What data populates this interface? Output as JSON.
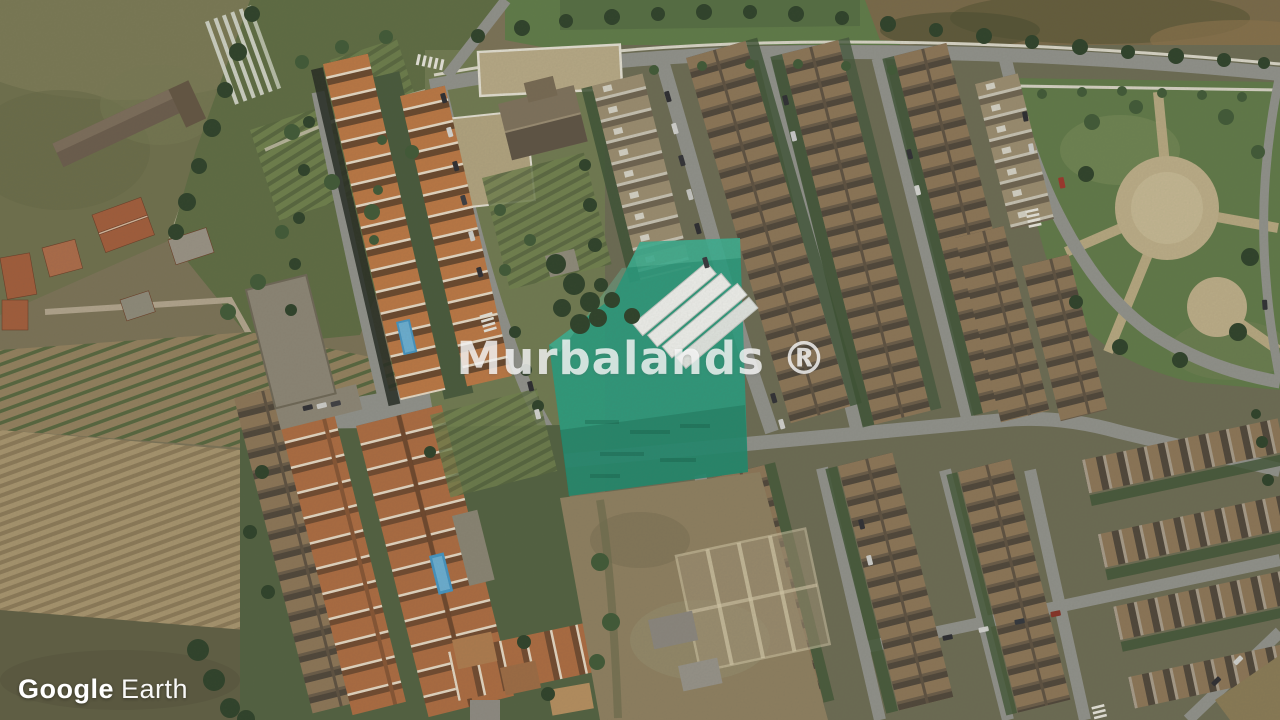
{
  "map": {
    "view_type": "satellite aerial imagery",
    "center_watermark": {
      "text": "Murbalands ®"
    },
    "attribution": {
      "brand": "Google",
      "product": "Earth"
    },
    "highlighted_plot": {
      "label": "highlighted land plot overlay",
      "color": "#1ea07f",
      "opacity": 0.88
    },
    "palette": {
      "road": "#90918a",
      "sidewalk": "#dcd8c8",
      "park-grass": "#5e7943",
      "field-olive": "#6e7048",
      "scrub": "#7a6844",
      "dirt-lot": "#8f7f5c",
      "plot-green": "#1ea07f",
      "pool": "#3e95c6",
      "warehouse": "#f2f3ef",
      "tree-dark": "#2b4025",
      "tree-mid": "#3d5832",
      "roof-orange": "#c0763d",
      "roof-terracotta": "#b06a3b",
      "roof-brown": "#8d7453"
    }
  }
}
